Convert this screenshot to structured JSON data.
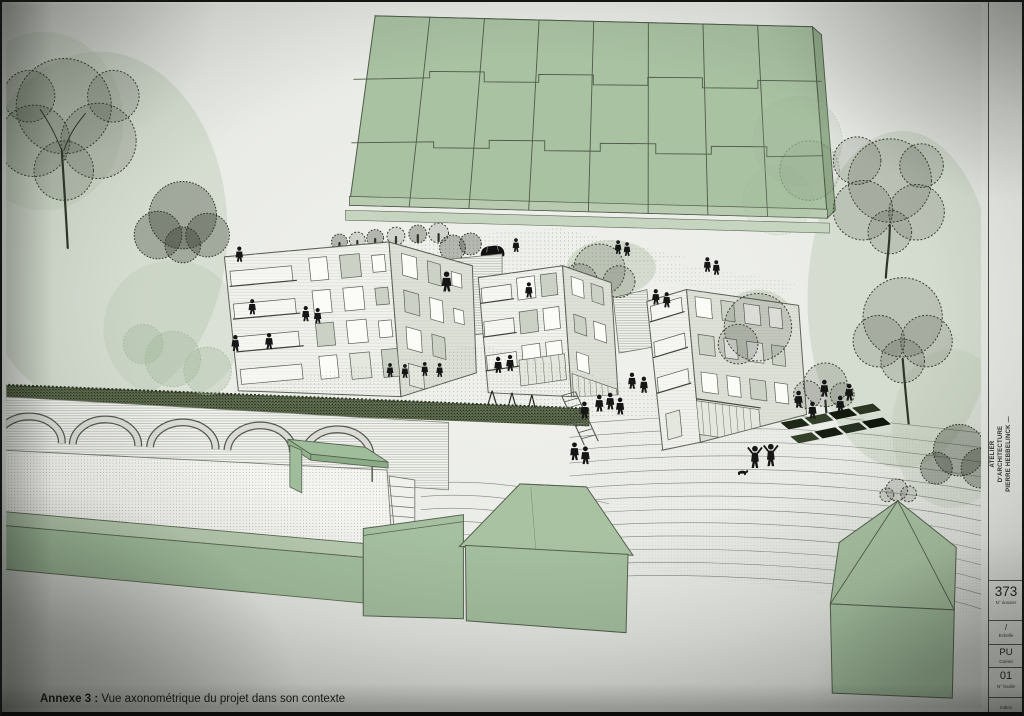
{
  "document": {
    "caption_label": "Annexe 3 :",
    "caption_text": " Vue axonométrique du projet dans son contexte"
  },
  "title_block": {
    "firm_lines": "ATELIER\nD'ARCHITECTURE\nPIERRE HEBBELINCK  —",
    "fields": [
      {
        "value": "373",
        "label": "N° dossier"
      },
      {
        "value": "/",
        "label": "Echelle"
      },
      {
        "value": "PU",
        "label": "Carnet"
      },
      {
        "value": "01",
        "label": "N° feuille"
      }
    ],
    "indice_label": "Indice"
  },
  "drawing": {
    "colors": {
      "green_building": "#a9c2a2",
      "green_light": "#c0d1b8",
      "paper": "#e7e9e4",
      "line": "#4e5a48",
      "hedge": "#57644a",
      "silhouette": "#161616"
    }
  }
}
